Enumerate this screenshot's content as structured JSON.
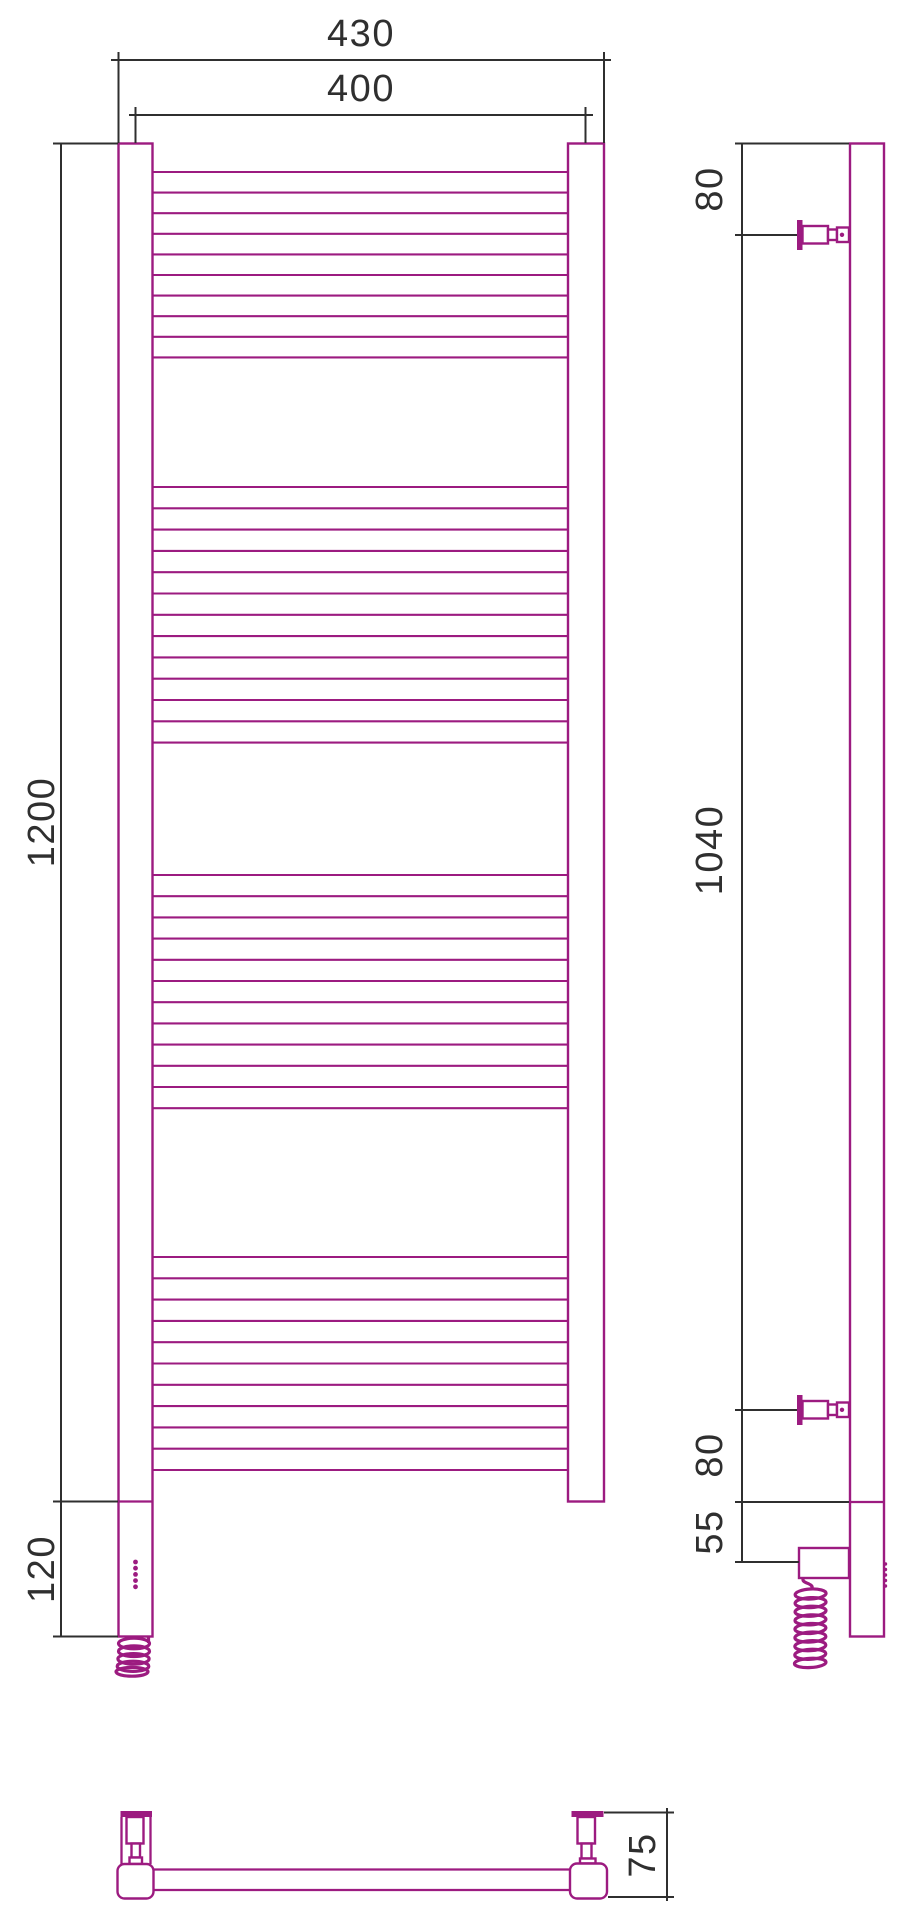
{
  "drawing": {
    "type": "technical-dimension-drawing",
    "subject": "ladder-towel-rail-with-electric-heating-element",
    "colors": {
      "outline": "#9C1B80",
      "dimension": "#2f2f2f",
      "background": "#ffffff"
    },
    "dimensions": {
      "overall_width": "430",
      "axis_width": "400",
      "height": "1200",
      "heater_section": "120",
      "top_bracket_offset": "80",
      "bracket_span": "1040",
      "bottom_bracket_offset": "80",
      "heater_below_rail": "55",
      "depth": "75"
    },
    "rungs": {
      "x1": 152.5,
      "x2": 568,
      "groups": [
        {
          "y": 172,
          "count": 10,
          "step": 20.6
        },
        {
          "y": 487,
          "count": 13,
          "step": 21.3
        },
        {
          "y": 875,
          "count": 12,
          "step": 21.2
        },
        {
          "y": 1257,
          "count": 11,
          "step": 21.3
        }
      ]
    },
    "led_indicator": {
      "front": {
        "cx": 135.5,
        "y0": 1562,
        "step": 6.2,
        "count": 5,
        "r": 2.4
      },
      "side": {
        "cx": 885.5,
        "y0": 1564,
        "step": 5.5,
        "count": 5,
        "r": 1.7
      }
    }
  }
}
